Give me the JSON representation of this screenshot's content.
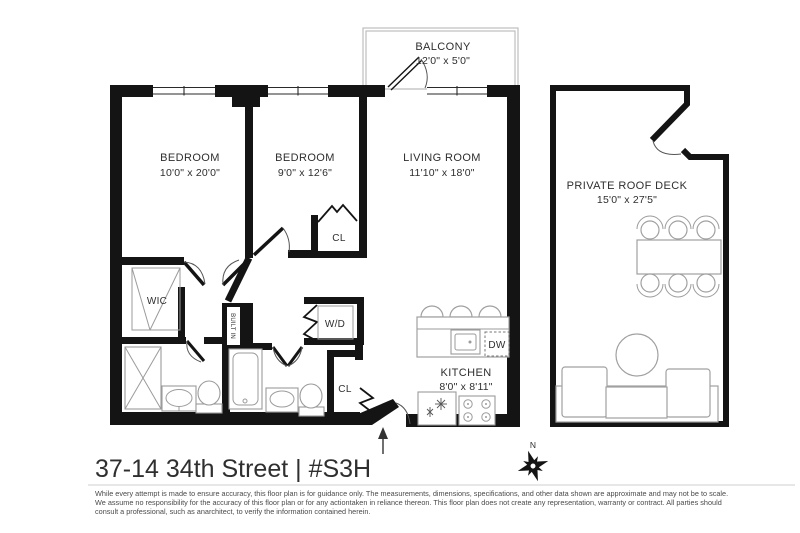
{
  "title": "37-14 34th Street | #S3H",
  "rooms": {
    "balcony": {
      "name": "BALCONY",
      "dims": "12'0\" x 5'0\""
    },
    "bedroom1": {
      "name": "BEDROOM",
      "dims": "10'0\" x 20'0\""
    },
    "bedroom2": {
      "name": "BEDROOM",
      "dims": "9'0\" x 12'6\""
    },
    "living": {
      "name": "LIVING ROOM",
      "dims": "11'10\" x 18'0\""
    },
    "roofdeck": {
      "name": "PRIVATE ROOF DECK",
      "dims": "15'0\" x 27'5\""
    },
    "kitchen": {
      "name": "KITCHEN",
      "dims": "8'0\" x 8'11\""
    }
  },
  "closets": {
    "wic": {
      "label": "WIC"
    },
    "cl_top": {
      "label": "CL"
    },
    "cl_bottom": {
      "label": "CL"
    },
    "wd": {
      "label": "W/D"
    },
    "builtin": {
      "label": "BUILT IN"
    }
  },
  "appliances": {
    "dw": {
      "label": "DW"
    }
  },
  "compass": {
    "north_label": "N"
  },
  "disclaimer": {
    "line1": "While every attempt is made to ensure accuracy, this floor plan is for guidance only. The measurements, dimensions, specifications, and other data shown are approximate and may not be to scale.",
    "line2": "We assume no responsibility for the accuracy of this floor plan or for any actiontaken in reliance thereon. This floor plan does not create any representation, warranty or contract. All parties should",
    "line3": "consult a professional, such as anarchitect, to verify the information contained herein."
  },
  "colors": {
    "wall": "#141414",
    "fixture_stroke": "#9b9b9b",
    "label_text": "#2e2e2e",
    "disclaimer_text": "#4a4a4a",
    "background": "#ffffff"
  }
}
